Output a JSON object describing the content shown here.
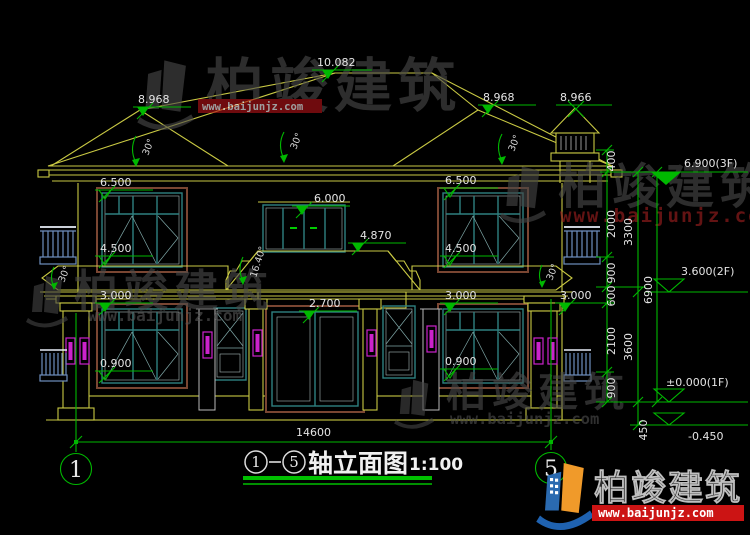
{
  "watermark": {
    "brand": "柏竣建筑",
    "url": "www.baijunjz.com"
  },
  "title": {
    "start_axis": "1",
    "end_axis": "5",
    "name": "轴立面图",
    "scale": "1:100"
  },
  "axis": {
    "left": "1",
    "right": "5",
    "overall_width": "14600"
  },
  "elevations": {
    "ridge": "10.082",
    "roof_break_left": "8.968",
    "roof_break_right": "8.968",
    "chimney_top": "8.966",
    "f2_window_head_left": "6.500",
    "f2_window_head_right": "6.500",
    "f2_door_head": "6.000",
    "porch_roof_top": "4.870",
    "f2_sill_left": "4.500",
    "f2_sill_right": "4.500",
    "wing_eave_left": "3.000",
    "wing_eave_right": "3.000",
    "wing_eave_far_right": "3.000",
    "entry_head": "2.700",
    "f1_sill_left": "0.900",
    "f1_sill_right": "0.900"
  },
  "angles": [
    "30°",
    "30°",
    "30°",
    "30°",
    "30°",
    "16.40°"
  ],
  "levels": [
    "6.900(3F)",
    "3.600(2F)",
    "±0.000(1F)",
    "-0.450"
  ],
  "right_dims": {
    "inner": [
      "400",
      "2000",
      "900",
      "600",
      "2100",
      "900"
    ],
    "middle": [
      "3300",
      "3600",
      "450"
    ],
    "total": "6900"
  }
}
